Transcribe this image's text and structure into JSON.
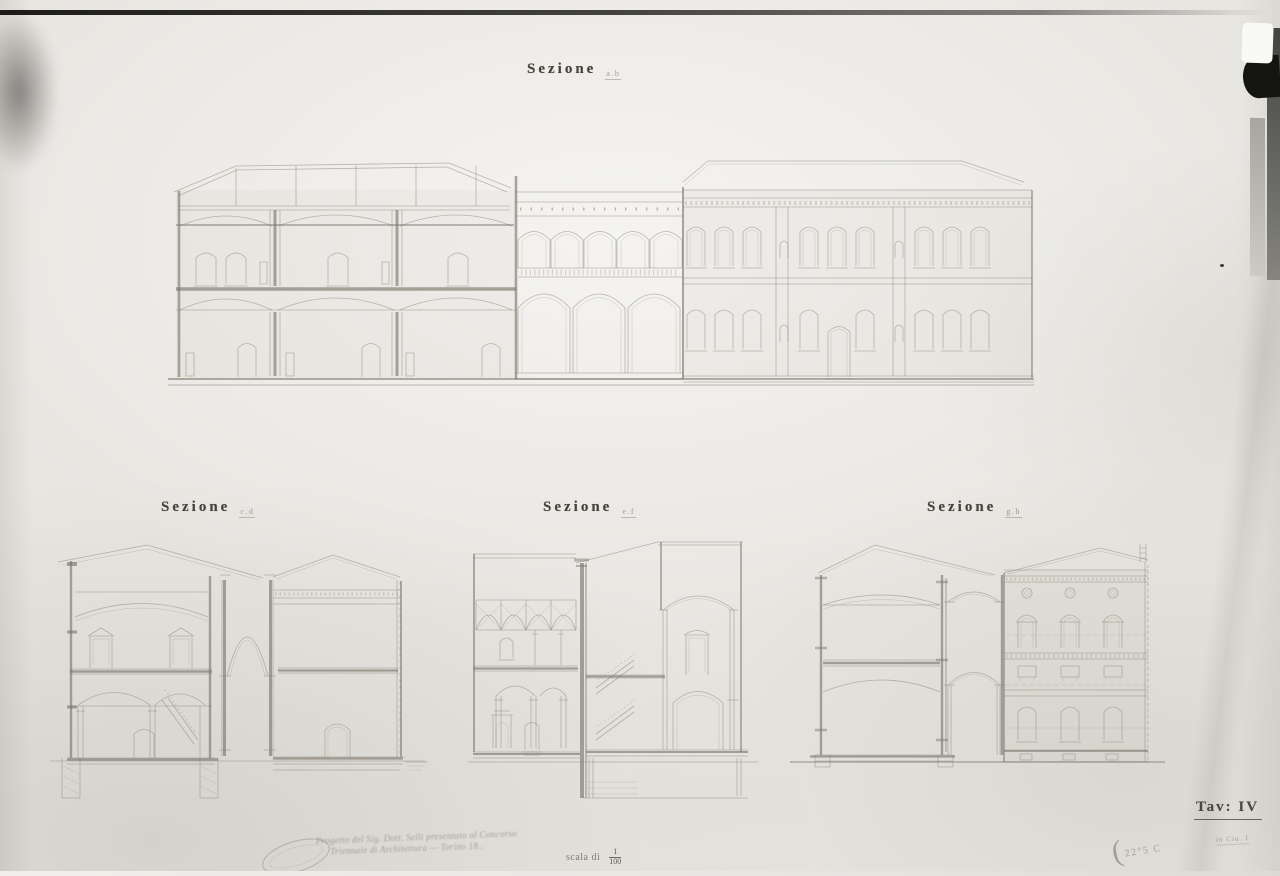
{
  "sheet": {
    "paper_color": "#e8e6e1",
    "ink_color": "#8a8478",
    "ink_dark_color": "#767064",
    "title_color": "#45423a",
    "pencil_color": "#9b968a"
  },
  "titles": {
    "main": {
      "word": "Sezione",
      "letters": "a.b"
    },
    "cd": {
      "word": "Sezione",
      "letters": "c.d"
    },
    "ef": {
      "word": "Sezione",
      "letters": "e.f"
    },
    "gh": {
      "word": "Sezione",
      "letters": "g.h"
    }
  },
  "footer": {
    "scale_label": "scala di",
    "scale_numerator": "1",
    "scale_denominator": "100",
    "plate_number": "Tav: IV",
    "handwritten_line1": "Progetto del Sig. Dott. Selli presentato al Concorso",
    "handwritten_line2": "Triennale di Architettura — Torino 18..",
    "pencil_paren": "(",
    "pencil_number": "22°5 C",
    "pencil_scribble": "in Cia. 1"
  }
}
